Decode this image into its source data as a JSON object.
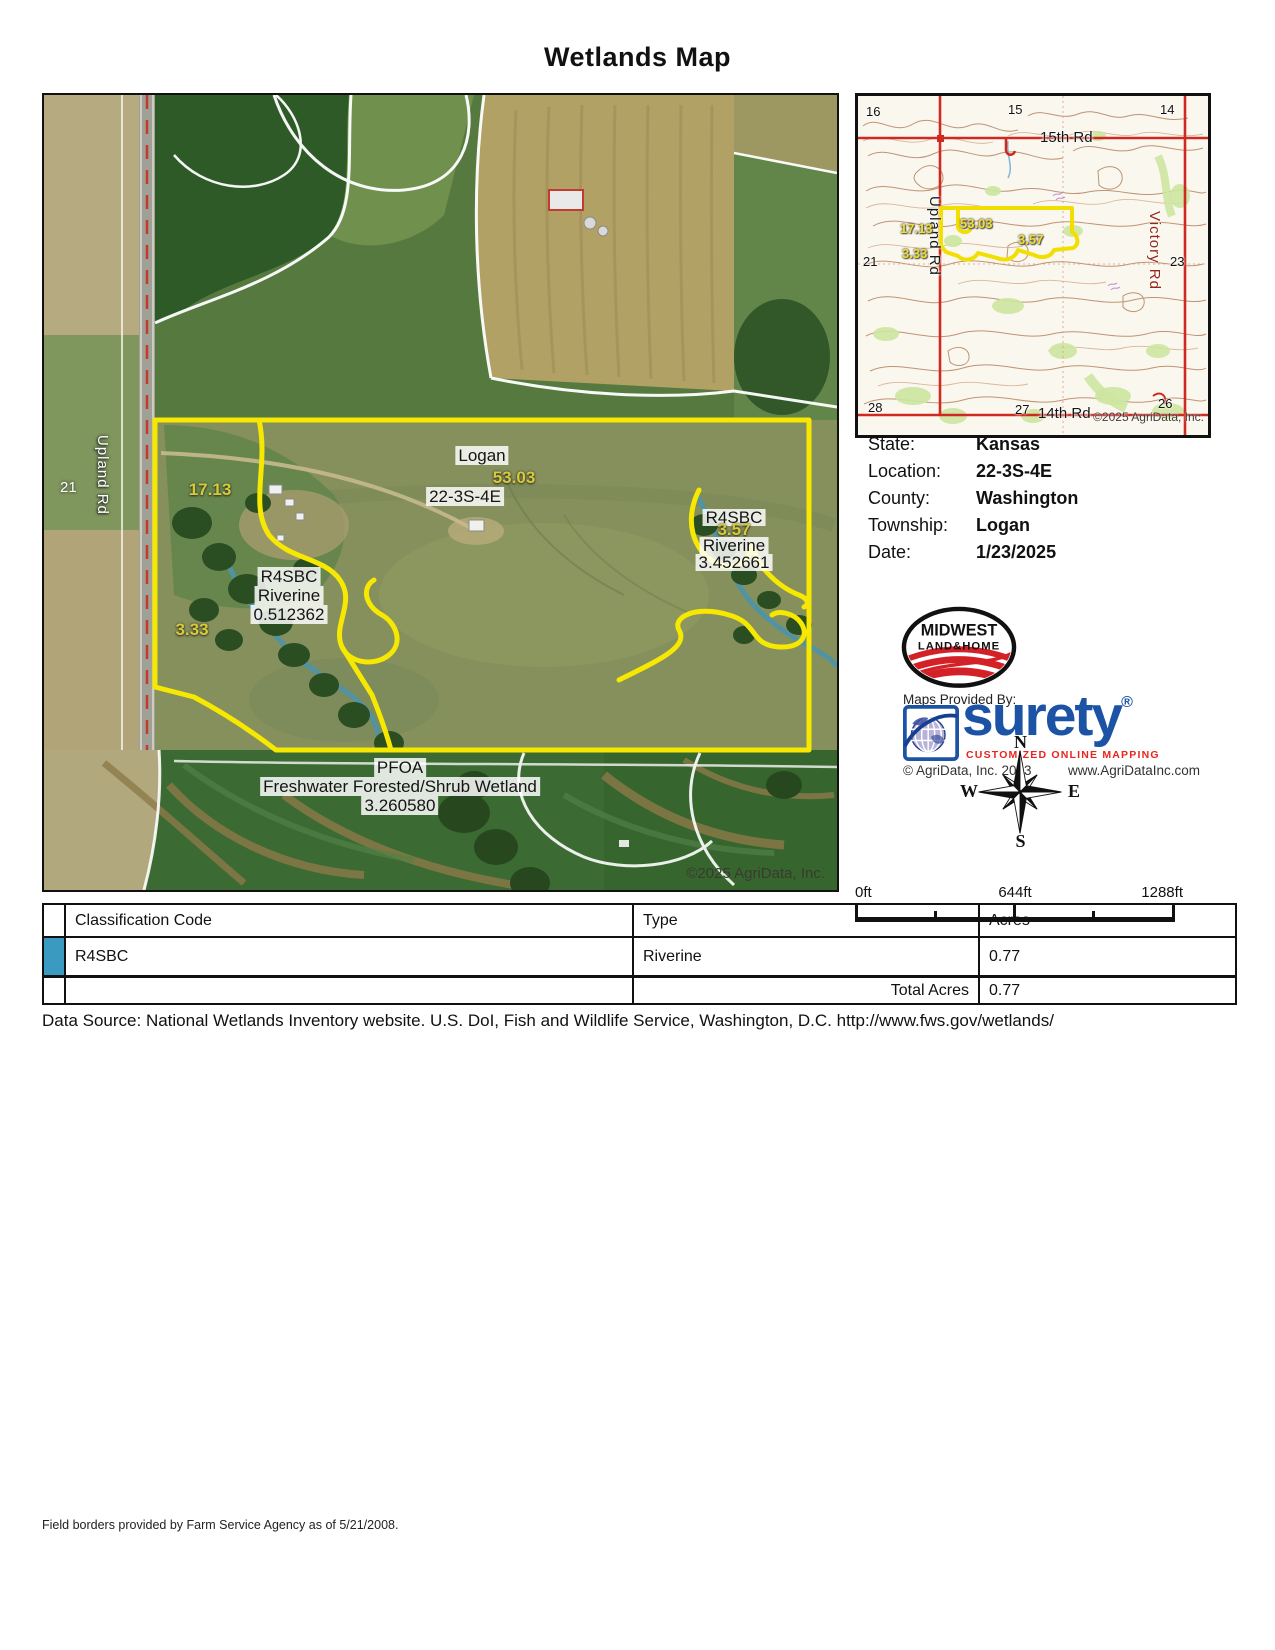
{
  "title": "Wetlands Map",
  "info": {
    "rows": [
      {
        "label": "State:",
        "value": "Kansas"
      },
      {
        "label": "Location:",
        "value": "22-3S-4E"
      },
      {
        "label": "County:",
        "value": "Washington"
      },
      {
        "label": "Township:",
        "value": "Logan"
      },
      {
        "label": "Date:",
        "value": "1/23/2025"
      }
    ]
  },
  "main_map": {
    "copyright": "©2025 AgriData, Inc.",
    "road_label": "Upland Rd",
    "section_number": "21",
    "township_label": "Logan",
    "section_label": "22-3S-4E",
    "acres_53": "53.03",
    "acres_17": "17.13",
    "acres_3_33": "3.33",
    "acres_3_57": "3.57",
    "wetland_west": {
      "code": "R4SBC",
      "type": "Riverine",
      "acres": "0.512362"
    },
    "wetland_east": {
      "code": "R4SBC",
      "type": "Riverine",
      "acres": "3.452661"
    },
    "wetland_south": {
      "code": "PFOA",
      "type": "Freshwater Forested/Shrub Wetland",
      "acres": "3.260580"
    }
  },
  "inset_map": {
    "copyright": "©2025 AgriData, Inc.",
    "road_top": "15th Rd",
    "road_bottom": "14th Rd",
    "road_left": "Upland Rd",
    "road_right": "Victory Rd",
    "sections": {
      "s16": "16",
      "s15": "15",
      "s14": "14",
      "s21": "21",
      "s23": "23",
      "s28": "28",
      "s27": "27",
      "s26": "26"
    },
    "acres_17": "17.13",
    "acres_53": "53.03",
    "acres_3_57": "3.57",
    "acres_3_33": "3.33"
  },
  "logos": {
    "midwest_line1": "MIDWEST",
    "midwest_line2": "LAND&HOME",
    "maps_provided_by": "Maps Provided By:",
    "surety_name": "surety",
    "surety_reg": "®",
    "surety_tagline": "CUSTOMIZED ONLINE MAPPING",
    "agridata_copyright": "© AgriData, Inc. 2023",
    "agridata_url": "www.AgriDataInc.com"
  },
  "compass": {
    "n": "N",
    "s": "S",
    "e": "E",
    "w": "W"
  },
  "scale": {
    "start": "0ft",
    "mid": "644ft",
    "end": "1288ft"
  },
  "table": {
    "header_classification": "Classification Code",
    "header_type": "Type",
    "header_acres": "Acres",
    "rows": [
      {
        "swatch_color": "#3a9abf",
        "code": "R4SBC",
        "type": "Riverine",
        "acres": "0.77"
      }
    ],
    "total_label": "Total Acres",
    "total_value": "0.77"
  },
  "data_source": "Data Source: National Wetlands Inventory website. U.S. DoI, Fish and Wildlife Service, Washington, D.C. http://www.fws.gov/wetlands/",
  "footer": "Field borders provided by Farm Service Agency as of 5/21/2008.",
  "colors": {
    "parcel_yellow": "#f6e800",
    "table_swatch": "#3a9abf",
    "surety_blue": "#1c53a5"
  }
}
